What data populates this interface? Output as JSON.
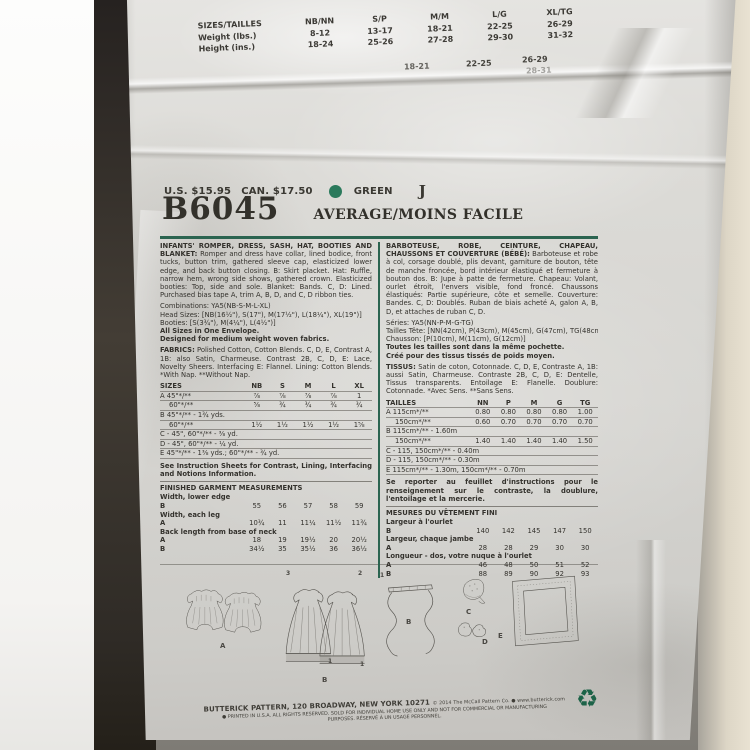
{
  "colors": {
    "accent_green": "#2b6450",
    "paper": "#d8d7d3",
    "ink": "#34322d",
    "swatch_green": "#2b7a5c"
  },
  "top_table": {
    "row_labels": [
      "SIZES/TAILLES",
      "Weight (lbs.)",
      "Height (ins.)"
    ],
    "col_headers": [
      "NB/NN",
      "S/P",
      "M/M",
      "L/G",
      "XL/TG"
    ],
    "weight": [
      "8-12",
      "13-17",
      "18-21",
      "22-25",
      "26-29"
    ],
    "height": [
      "18-24",
      "25-26",
      "27-28",
      "29-30",
      "31-32"
    ],
    "fragments": [
      "18-21",
      "22-25",
      "26-29",
      "28-31"
    ]
  },
  "price": {
    "us": "U.S. $15.95",
    "can": "CAN. $17.50",
    "color_word": "GREEN",
    "letter": "J"
  },
  "title": {
    "number": "B6045",
    "difficulty": "AVERAGE/MOINS FACILE"
  },
  "english": {
    "desc_heading": "INFANTS' ROMPER, DRESS, SASH, HAT, BOOTIES AND BLANKET:",
    "desc_body": " Romper and dress have collar, lined bodice, front tucks, button trim, gathered sleeve cap, elasticized lower edge, and back button closing. B: Skirt placket. Hat: Ruffle, narrow hem, wrong side shows, gathered crown. Elasticized booties: Top, side and sole. Blanket: Bands. C, D: Lined. Purchased bias tape A, trim A, B, D, and C, D ribbon ties.",
    "combinations": "Combinations: YA5(NB-S-M-L-XL)",
    "head_sizes": "Head Sizes: [NB(16½\"), S(17\"), M(17½\"), L(18¼\"), XL(19\")]",
    "booties": "Booties: [S(3¾\"), M(4¼\"), L(4½\")]",
    "all_sizes": "All Sizes in One Envelope.",
    "designed": "Designed for medium weight woven fabrics.",
    "fabrics_label": "FABRICS:",
    "fabrics_body": " Polished Cotton, Cotton Blends. C, D, E, Contrast A, 1B: also Satin, Charmeuse. Contrast 2B, C, D, E: Lace, Novelty Sheers. Interfacing E: Flannel. Lining: Cotton Blends. *With Nap. **Without Nap.",
    "yardage": {
      "header_label": "SIZES",
      "header_cols": [
        "NB",
        "S",
        "M",
        "L",
        "XL"
      ],
      "rows": [
        {
          "label": "A 45\"*/**",
          "values": [
            "⅞",
            "⅞",
            "⅞",
            "⅞",
            "1"
          ]
        },
        {
          "label": "60\"*/**",
          "values": [
            "⅝",
            "¾",
            "¾",
            "¾",
            "¾"
          ]
        },
        {
          "label": "B 45\"*/** - 1¾ yds.",
          "values": []
        },
        {
          "label": "60\"*/**",
          "values": [
            "1½",
            "1½",
            "1½",
            "1½",
            "1⅝"
          ]
        },
        {
          "label": "C - 45\", 60\"*/** - ⅜ yd.",
          "values": []
        },
        {
          "label": "D - 45\", 60\"*/** - ¼ yd.",
          "values": []
        },
        {
          "label": "E 45\"*/** - 1⅜ yds.; 60\"*/** - ¾ yd.",
          "values": []
        }
      ]
    },
    "see_note": "See Instruction Sheets for Contrast, Lining, Interfacing and Notions Information.",
    "finished_heading": "FINISHED GARMENT MEASUREMENTS",
    "finished_rows": [
      {
        "label": "Width, lower edge",
        "values": []
      },
      {
        "label": "B",
        "values": [
          "55",
          "56",
          "57",
          "58",
          "59"
        ]
      },
      {
        "label": "Width, each leg",
        "values": []
      },
      {
        "label": "A",
        "values": [
          "10¾",
          "11",
          "11¼",
          "11½",
          "11¾"
        ]
      },
      {
        "label": "Back length from base of neck",
        "values": []
      },
      {
        "label": "A",
        "values": [
          "18",
          "19",
          "19½",
          "20",
          "20½"
        ]
      },
      {
        "label": "B",
        "values": [
          "34½",
          "35",
          "35½",
          "36",
          "36½"
        ]
      }
    ]
  },
  "french": {
    "desc_heading": "BARBOTEUSE, ROBE, CEINTURE, CHAPEAU, CHAUSSONS ET COUVERTURE (BÉBÉ):",
    "desc_body": " Barboteuse et robe à col, corsage doublé, plis devant, garniture de bouton, tête de manche froncée, bord intérieur élastiqué et fermeture à bouton dos. B: Jupe à patte de fermeture. Chapeau: Volant, ourlet étroit, l'envers visible, fond froncé. Chaussons élastiqués: Partie supérieure, côte et semelle. Couverture: Bandes. C, D: Doublés. Ruban de biais acheté A, galon A, B, D, et attaches de ruban C, D.",
    "combinations": "Séries: YA5(NN-P-M-G-TG)",
    "head_sizes": "Tailles Tête: [NN(42cm), P(43cm), M(45cm), G(47cm), TG(48cm)]",
    "booties": "Chausson: [P(10cm), M(11cm), G(12cm)]",
    "all_sizes": "Toutes les tailles sont dans la même pochette.",
    "designed": "Créé pour des tissus tissés de poids moyen.",
    "fabrics_label": "TISSUS:",
    "fabrics_body": " Satin de coton, Cotonnade. C, D, E, Contraste A, 1B: aussi Satin, Charmeuse. Contraste 2B, C, D, E: Dentelle, Tissus transparents. Entoilage E: Flanelle. Doublure: Cotonnade. *Avec Sens. **Sans Sens.",
    "yardage": {
      "header_label": "TAILLES",
      "header_cols": [
        "NN",
        "P",
        "M",
        "G",
        "TG"
      ],
      "rows": [
        {
          "label": "A 115cm*/**",
          "values": [
            "0.80",
            "0.80",
            "0.80",
            "0.80",
            "1.00"
          ]
        },
        {
          "label": "150cm*/**",
          "values": [
            "0.60",
            "0.70",
            "0.70",
            "0.70",
            "0.70"
          ]
        },
        {
          "label": "B 115cm*/** - 1.60m",
          "values": []
        },
        {
          "label": "150cm*/**",
          "values": [
            "1.40",
            "1.40",
            "1.40",
            "1.40",
            "1.50"
          ]
        },
        {
          "label": "C - 115, 150cm*/** - 0.40m",
          "values": []
        },
        {
          "label": "D - 115, 150cm*/** - 0.30m",
          "values": []
        },
        {
          "label": "E 115cm*/** - 1.30m, 150cm*/** - 0.70m",
          "values": []
        }
      ]
    },
    "see_note": "Se reporter au feuillet d'instructions pour le renseignement sur le contraste, la doublure, l'entoilage et la mercerie.",
    "finished_heading": "MESURES DU VÊTEMENT FINI",
    "finished_rows": [
      {
        "label": "Largeur à l'ourlet",
        "values": []
      },
      {
        "label": "B",
        "values": [
          "140",
          "142",
          "145",
          "147",
          "150"
        ]
      },
      {
        "label": "Largeur, chaque jambe",
        "values": []
      },
      {
        "label": "A",
        "values": [
          "28",
          "28",
          "29",
          "30",
          "30"
        ]
      },
      {
        "label": "Longueur - dos, votre nuque à l'ourlet",
        "values": []
      },
      {
        "label": "A",
        "values": [
          "46",
          "48",
          "50",
          "51",
          "52"
        ]
      },
      {
        "label": "B",
        "values": [
          "88",
          "89",
          "90",
          "92",
          "93"
        ]
      }
    ]
  },
  "drawings": {
    "labels": {
      "romper": "A",
      "dress": "B",
      "sash": "B",
      "hat": "C",
      "booties": "D",
      "blanket": "E"
    },
    "numbers": {
      "dress_left": "3",
      "dress_right": "2",
      "dress_hem_left": "1",
      "dress_hem_right": "1",
      "sash": "1"
    }
  },
  "footer": {
    "line1": "BUTTERICK PATTERN, 120 BROADWAY, NEW YORK 10271",
    "line1b": "© 2014 The McCall Pattern Co. ● www.butterick.com",
    "line2": "● PRINTED IN U.S.A. ALL RIGHTS RESERVED. SOLD FOR INDIVIDUAL HOME USE ONLY AND NOT FOR COMMERCIAL OR MANUFACTURING",
    "line3": "PURPOSES. RÉSERVÉ À UN USAGE PERSONNEL.",
    "recycle_icon": "♻"
  }
}
